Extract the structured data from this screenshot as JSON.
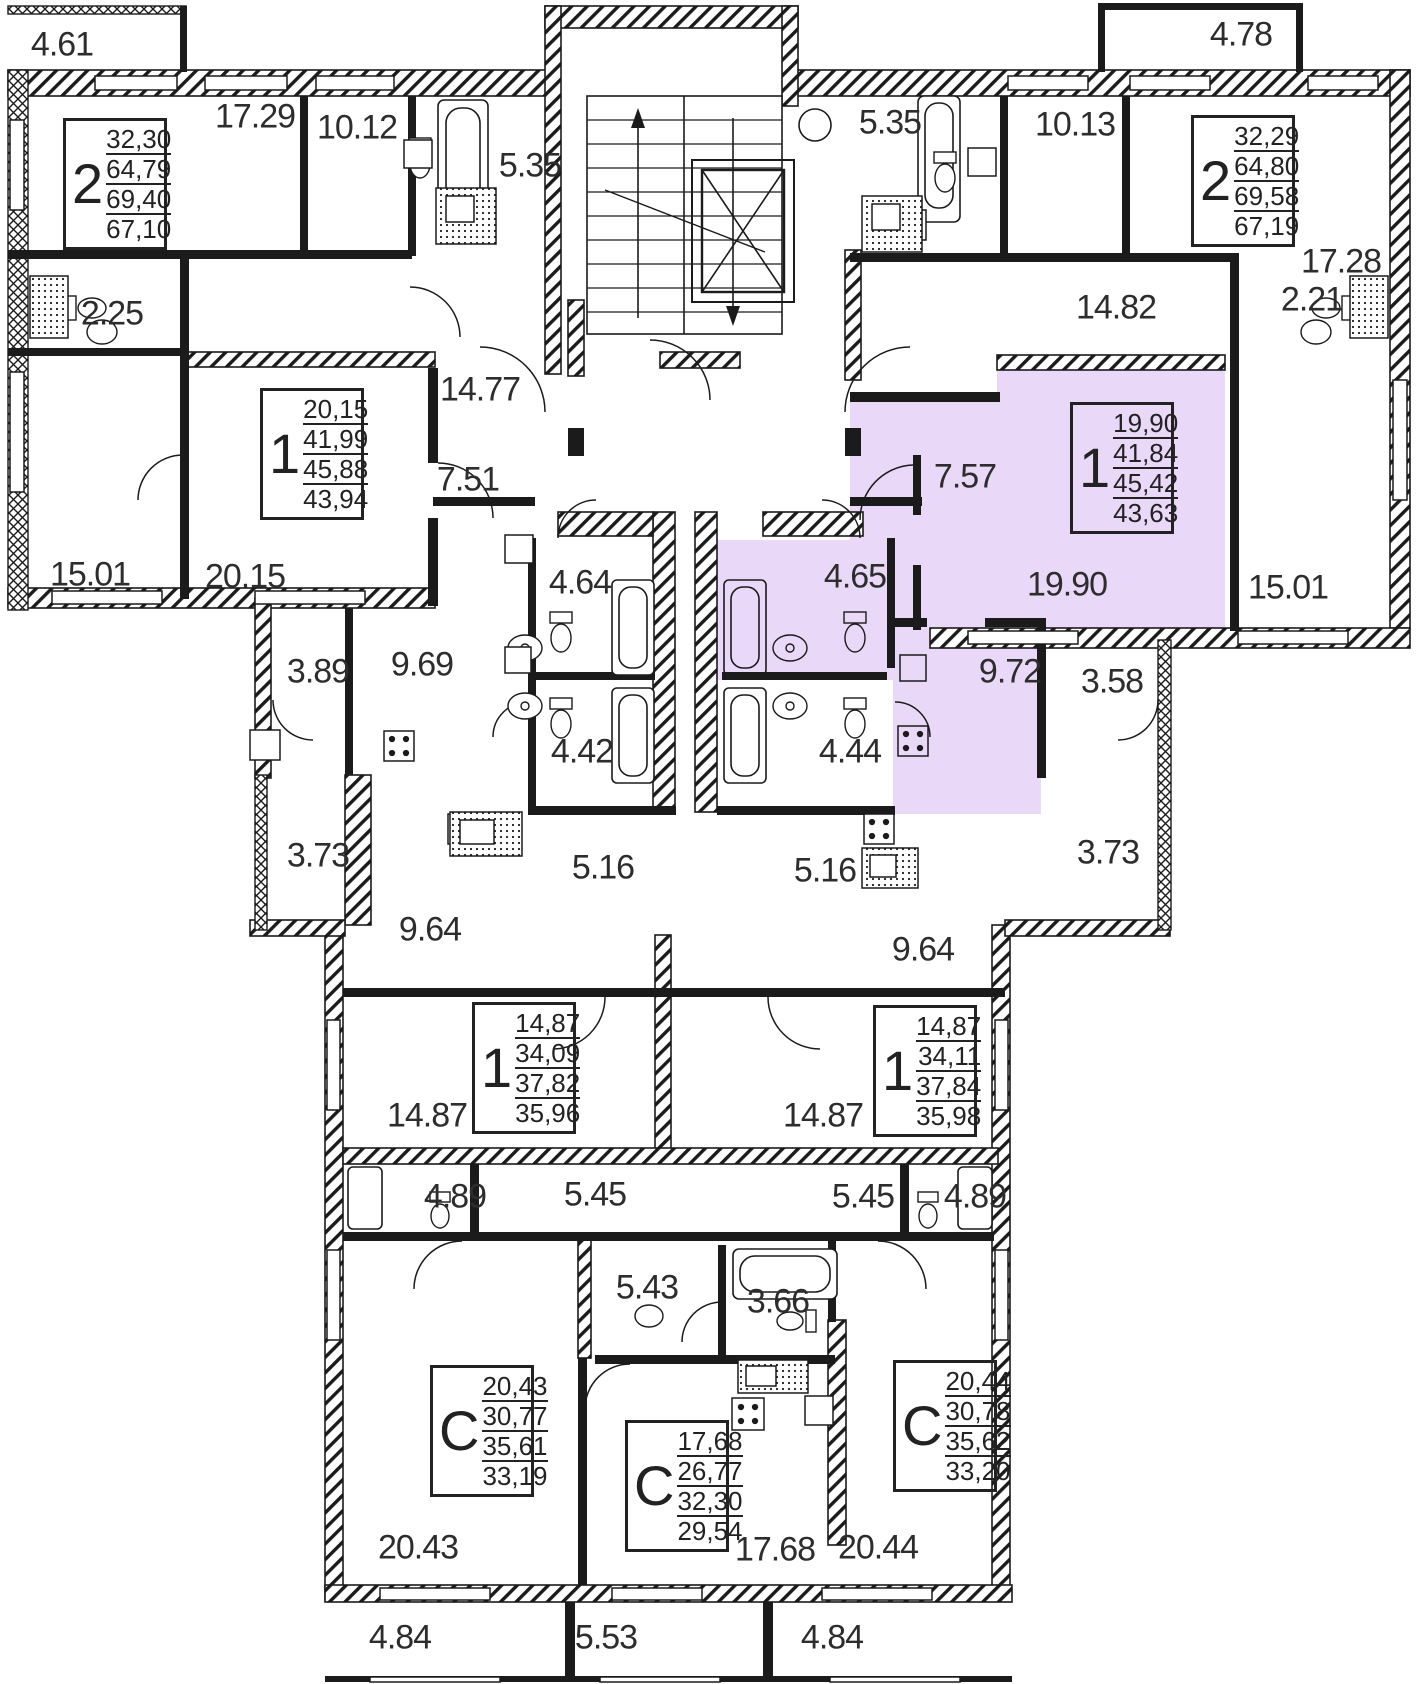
{
  "floor_plan": {
    "highlight_color": "#e9d8f7",
    "wall_color": "#1b1b1b",
    "apartments": [
      {
        "id": "apt-2room-top-left",
        "type": "2",
        "areas": [
          "32,30",
          "64,79",
          "69,40",
          "67,10"
        ],
        "x": 63,
        "y": 118,
        "highlighted": false
      },
      {
        "id": "apt-2room-top-right",
        "type": "2",
        "areas": [
          "32,29",
          "64,80",
          "69,58",
          "67,19"
        ],
        "x": 1191,
        "y": 115,
        "highlighted": false
      },
      {
        "id": "apt-1room-mid-left",
        "type": "1",
        "areas": [
          "20,15",
          "41,99",
          "45,88",
          "43,94"
        ],
        "x": 260,
        "y": 388,
        "highlighted": false
      },
      {
        "id": "apt-1room-mid-right",
        "type": "1",
        "areas": [
          "19,90",
          "41,84",
          "45,42",
          "43,63"
        ],
        "x": 1070,
        "y": 402,
        "highlighted": true
      },
      {
        "id": "apt-1room-low-left",
        "type": "1",
        "areas": [
          "14,87",
          "34,09",
          "37,82",
          "35,96"
        ],
        "x": 472,
        "y": 1002,
        "highlighted": false
      },
      {
        "id": "apt-1room-low-right",
        "type": "1",
        "areas": [
          "14,87",
          "34,11",
          "37,84",
          "35,98"
        ],
        "x": 873,
        "y": 1005,
        "highlighted": false
      },
      {
        "id": "apt-studio-left",
        "type": "С",
        "areas": [
          "20,43",
          "30,77",
          "35,61",
          "33,19"
        ],
        "x": 430,
        "y": 1365,
        "highlighted": false
      },
      {
        "id": "apt-studio-mid",
        "type": "С",
        "areas": [
          "17,68",
          "26,77",
          "32,30",
          "29,54"
        ],
        "x": 625,
        "y": 1420,
        "highlighted": false
      },
      {
        "id": "apt-studio-right",
        "type": "С",
        "areas": [
          "20,44",
          "30,78",
          "35,62",
          "33,20"
        ],
        "x": 893,
        "y": 1360,
        "highlighted": false
      }
    ],
    "room_labels": [
      {
        "text": "4.61",
        "x": 62,
        "y": 45,
        "highlighted": false
      },
      {
        "text": "17.29",
        "x": 255,
        "y": 117,
        "highlighted": false
      },
      {
        "text": "10.12",
        "x": 357,
        "y": 128,
        "highlighted": false
      },
      {
        "text": "5.35",
        "x": 530,
        "y": 166,
        "highlighted": false
      },
      {
        "text": "2.25",
        "x": 112,
        "y": 314,
        "highlighted": false
      },
      {
        "text": "15.01",
        "x": 90,
        "y": 575,
        "highlighted": false
      },
      {
        "text": "20.15",
        "x": 245,
        "y": 577,
        "highlighted": false
      },
      {
        "text": "14.77",
        "x": 480,
        "y": 390,
        "highlighted": false
      },
      {
        "text": "7.51",
        "x": 468,
        "y": 480,
        "highlighted": false
      },
      {
        "text": "4.64",
        "x": 580,
        "y": 583,
        "highlighted": false
      },
      {
        "text": "3.89",
        "x": 318,
        "y": 672,
        "highlighted": false
      },
      {
        "text": "9.69",
        "x": 422,
        "y": 665,
        "highlighted": false
      },
      {
        "text": "4.42",
        "x": 582,
        "y": 752,
        "highlighted": false
      },
      {
        "text": "3.73",
        "x": 318,
        "y": 856,
        "highlighted": false
      },
      {
        "text": "5.16",
        "x": 603,
        "y": 868,
        "highlighted": false
      },
      {
        "text": "9.64",
        "x": 430,
        "y": 930,
        "highlighted": false
      },
      {
        "text": "4.78",
        "x": 1241,
        "y": 35,
        "highlighted": false
      },
      {
        "text": "5.35",
        "x": 890,
        "y": 123,
        "highlighted": false
      },
      {
        "text": "10.13",
        "x": 1075,
        "y": 125,
        "highlighted": false
      },
      {
        "text": "17.28",
        "x": 1341,
        "y": 262,
        "highlighted": false
      },
      {
        "text": "2.21",
        "x": 1312,
        "y": 300,
        "highlighted": false
      },
      {
        "text": "14.82",
        "x": 1116,
        "y": 308,
        "highlighted": false
      },
      {
        "text": "7.57",
        "x": 965,
        "y": 477,
        "highlighted": true
      },
      {
        "text": "19.90",
        "x": 1067,
        "y": 585,
        "highlighted": true
      },
      {
        "text": "15.01",
        "x": 1288,
        "y": 588,
        "highlighted": false
      },
      {
        "text": "4.65",
        "x": 855,
        "y": 577,
        "highlighted": true
      },
      {
        "text": "9.72",
        "x": 1010,
        "y": 672,
        "highlighted": true
      },
      {
        "text": "3.58",
        "x": 1112,
        "y": 682,
        "highlighted": false
      },
      {
        "text": "4.44",
        "x": 850,
        "y": 752,
        "highlighted": false
      },
      {
        "text": "3.73",
        "x": 1108,
        "y": 853,
        "highlighted": false
      },
      {
        "text": "5.16",
        "x": 825,
        "y": 871,
        "highlighted": false
      },
      {
        "text": "9.64",
        "x": 923,
        "y": 950,
        "highlighted": false
      },
      {
        "text": "14.87",
        "x": 427,
        "y": 1116,
        "highlighted": false
      },
      {
        "text": "14.87",
        "x": 823,
        "y": 1116,
        "highlighted": false
      },
      {
        "text": "4.89",
        "x": 455,
        "y": 1197,
        "highlighted": false
      },
      {
        "text": "5.45",
        "x": 595,
        "y": 1195,
        "highlighted": false
      },
      {
        "text": "5.45",
        "x": 863,
        "y": 1197,
        "highlighted": false
      },
      {
        "text": "4.89",
        "x": 975,
        "y": 1197,
        "highlighted": false
      },
      {
        "text": "5.43",
        "x": 647,
        "y": 1288,
        "highlighted": false
      },
      {
        "text": "3.66",
        "x": 778,
        "y": 1302,
        "highlighted": false
      },
      {
        "text": "20.43",
        "x": 418,
        "y": 1548,
        "highlighted": false
      },
      {
        "text": "17.68",
        "x": 775,
        "y": 1550,
        "highlighted": false
      },
      {
        "text": "20.44",
        "x": 878,
        "y": 1548,
        "highlighted": false
      },
      {
        "text": "4.84",
        "x": 400,
        "y": 1638,
        "highlighted": false
      },
      {
        "text": "5.53",
        "x": 606,
        "y": 1638,
        "highlighted": false
      },
      {
        "text": "4.84",
        "x": 832,
        "y": 1638,
        "highlighted": false
      }
    ]
  }
}
